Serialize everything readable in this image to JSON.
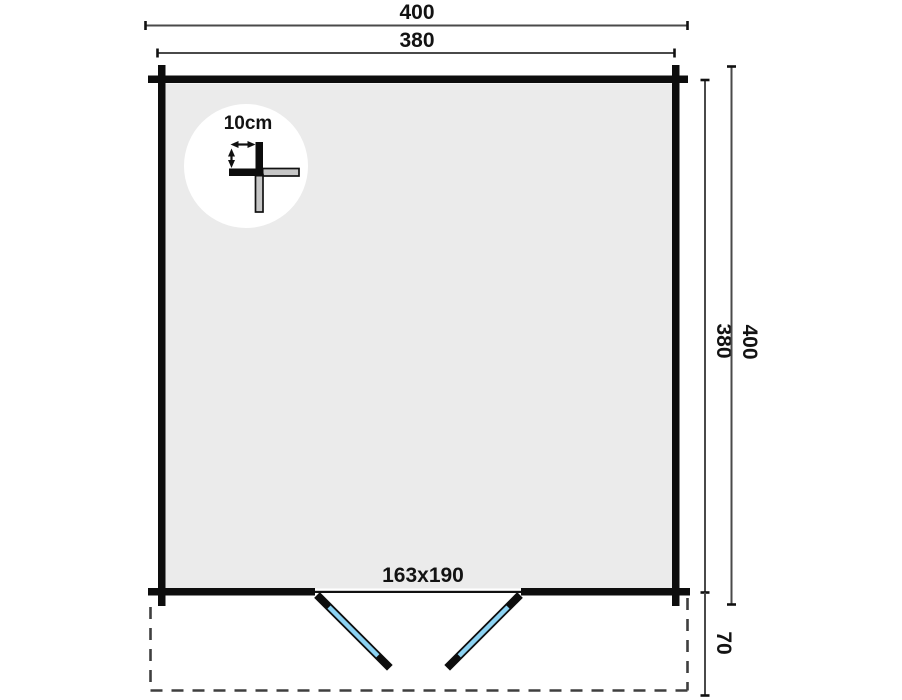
{
  "diagram": {
    "kind": "log-cabin floor plan",
    "dimensions": {
      "top_overall": "400",
      "top_walls": "380",
      "side_walls": "380",
      "side_overall": "400",
      "terrace_depth": "70",
      "door_size": "163x190",
      "wall_thickness": "10cm"
    },
    "colors": {
      "wall": "#0d0d0d",
      "floor": "#ebebeb",
      "door_glass": "#8bd2f2",
      "detail_gray": "#c6c6c6",
      "dim_line": "#4a4a4a",
      "dashed_outline": "#3f3f3f"
    }
  }
}
